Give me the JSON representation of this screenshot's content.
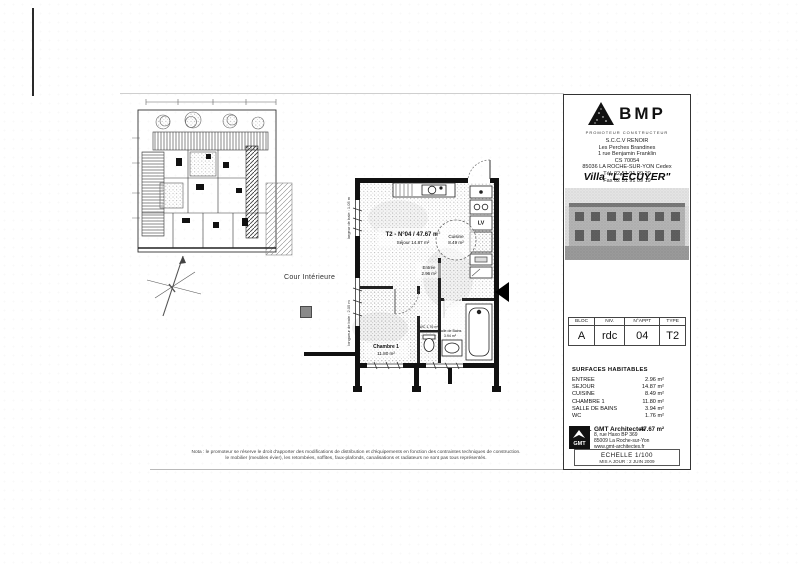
{
  "title_block": {
    "logo_text": "BMP",
    "logo_tagline": "PROMOTEUR CONSTRUCTEUR",
    "address_lines": [
      "S.C.C.V RENOIR",
      "Les Perches Brandines",
      "1 rue Benjamin Franklin",
      "CS 70054",
      "85036 LA ROCHE-SUR-YON Cedex",
      "Tél. 02 51 91 09 20",
      "Fax 02 51 91 09 19"
    ],
    "project_title": "Villa \"L'ECUYER\"",
    "info_table": {
      "headers": [
        "BLOC",
        "NIV.",
        "N°APPT",
        "TYPE"
      ],
      "values": [
        "A",
        "rdc",
        "04",
        "T2"
      ]
    },
    "surfaces": {
      "title": "SURFACES HABITABLES",
      "rows": [
        {
          "label": "ENTREE",
          "value": "2.96 m²"
        },
        {
          "label": "SEJOUR",
          "value": "14.87 m²"
        },
        {
          "label": "CUISINE",
          "value": "8.49 m²"
        },
        {
          "label": "CHAMBRE 1",
          "value": "11.80 m²"
        },
        {
          "label": "SALLE DE BAINS",
          "value": "3.94 m²"
        },
        {
          "label": "WC",
          "value": "1.76 m²"
        }
      ],
      "total_label": "TOTAL",
      "total_value": "47.67 m²"
    },
    "architect": {
      "logo_text": "GMT",
      "name": "GMT Architectes",
      "lines": [
        "8, rue Haxo BP 369",
        "85009 La Roche-sur-Yon",
        "www.gmt-architectes.fr"
      ]
    },
    "scale_box": {
      "scale": "ECHELLE 1/100",
      "updated": "MIS A JOUR : 2 JUIN 2009"
    }
  },
  "plan": {
    "unit_label": "T2 - N°04 / 47.67 m²",
    "sejour_label": "Séjour 14.87 m²",
    "cuisine_label": "Cuisine",
    "cuisine_area": "8.49 m²",
    "entree_label": "Entrée",
    "entree_area": "2.96 m²",
    "chambre_label": "Chambre 1",
    "chambre_area": "11.80 m²",
    "sdb_label": "Salle de Bains",
    "sdb_area": "3.94 m²",
    "wc_label": "WC 1.76 m²",
    "appliance_lv": "LV",
    "dim_left_top": "largeur de baie : 1.05 m",
    "dim_left_bottom": "longueur de baie : 2.05 m",
    "cour_label": "Cour Intérieure"
  },
  "footer": {
    "disclaimer_line1": "Nota : le promoteur se réserve le droit d'apporter des modifications de distribution et d'équipements en fonction des contraintes techniques de construction.",
    "disclaimer_line2": "le mobilier (meubles évier), les retombées, soffites, faux-plafonds, canalisations et radiateurs ne sont pas tous représentés."
  }
}
